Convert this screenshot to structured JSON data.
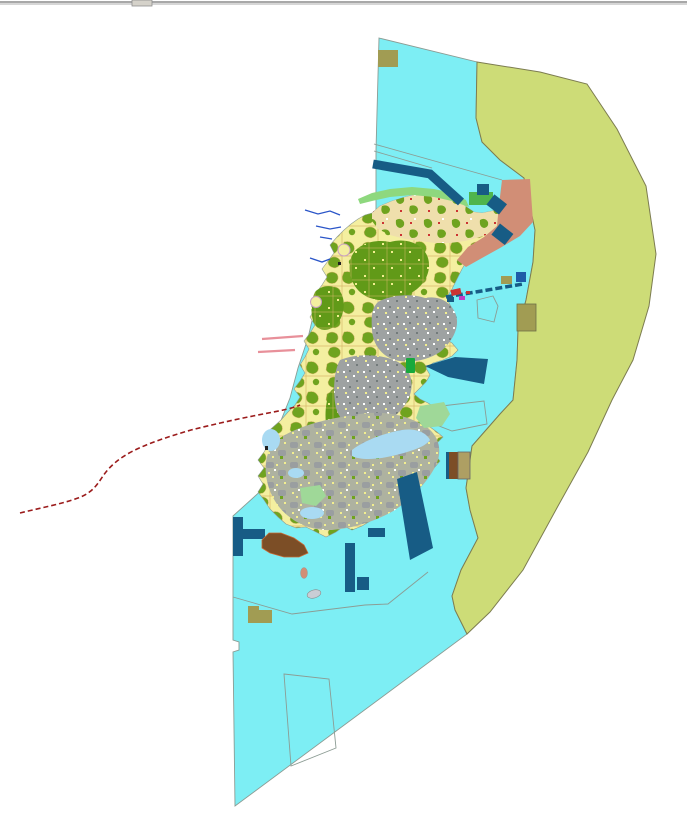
{
  "window": {
    "divider_color": "#A8A8A8",
    "divider_highlight": "#D6D6D6",
    "handle_color": "#D5D2CA",
    "handle_border": "#8F8F8F"
  },
  "map": {
    "background": "#FFFFFF",
    "palette": {
      "water": "#7DEEF4",
      "water_outline": "#8C9C94",
      "coastal_zone": "#CDDC77",
      "coastal_zone_outline": "#7C7C50",
      "farmland": "#F4EFA0",
      "wheat": "#EFDFAC",
      "forest": "#6FA31F",
      "forest_dark": "#619A18",
      "parcel_line": "#D9B86A",
      "urban": "#9EA2A2",
      "urban_dark": "#737B7B",
      "sprawl": "#AEB2A0",
      "sprawl_gray": "#9A9EA0",
      "beach_green": "#8ED87E",
      "green_rect": "#4FB54C",
      "bright_green": "#17A93C",
      "light_green": "#9FD898",
      "shallow_water": "#A9DAF2",
      "salmon": "#D18E76",
      "navy": "#175C85",
      "royal_blue": "#1E5CA8",
      "khaki": "#A19C53",
      "khaki_outline": "#6E6E46",
      "tan_box": "#AE9F63",
      "brown": "#7C4E26",
      "brown_outline": "#C86832",
      "red_boundary": "#9B1B1B",
      "river_blue": "#2A55C8",
      "road_pink": "#E8909A",
      "islet_gray": "#C9CDD5",
      "speck_red": "#CC3333",
      "speck_magenta": "#C23BC2",
      "speck_dark": "#222222",
      "speck_white": "#FFFFFF",
      "speck_yellow": "#F2EE90"
    }
  }
}
